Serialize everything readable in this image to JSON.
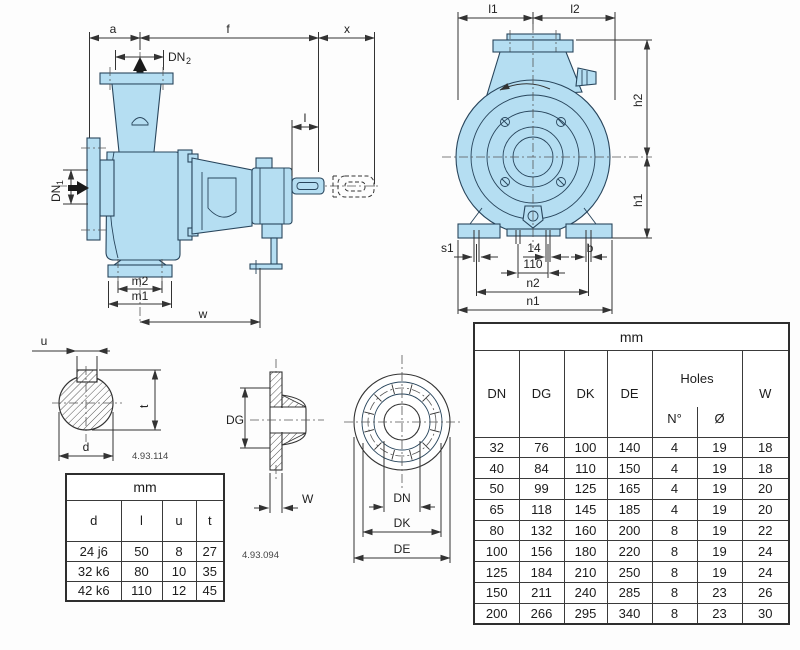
{
  "colors": {
    "pump_fill": "#b5def2",
    "line_color": "#333333",
    "table_border": "#3a3a3a",
    "background": "#fdfdfd"
  },
  "side_view": {
    "labels": {
      "a": "a",
      "f": "f",
      "x": "x",
      "dn2_base": "DN",
      "dn2_sub": "2",
      "dn1_base": "DN",
      "dn1_sub": "1",
      "l": "l",
      "m2": "m2",
      "m1": "m1",
      "w": "w"
    }
  },
  "front_view": {
    "labels": {
      "l1": "l1",
      "l2": "l2",
      "h2": "h2",
      "h1": "h1",
      "s1": "s1",
      "slot_width": "14",
      "slot_spacing": "110",
      "b": "b",
      "n2": "n2",
      "n1": "n1"
    }
  },
  "shaft_detail": {
    "labels": {
      "u": "u",
      "t": "t",
      "d": "d"
    },
    "code": "4.93.114"
  },
  "flange_detail": {
    "labels": {
      "dg": "DG",
      "w": "W",
      "dn": "DN",
      "dk": "DK",
      "de": "DE"
    },
    "code": "4.93.094"
  },
  "shaft_table": {
    "unit_header": "mm",
    "columns": [
      "d",
      "l",
      "u",
      "t"
    ],
    "rows": [
      [
        "24 j6",
        "50",
        "8",
        "27"
      ],
      [
        "32 k6",
        "80",
        "10",
        "35"
      ],
      [
        "42 k6",
        "110",
        "12",
        "45"
      ]
    ]
  },
  "flange_table": {
    "unit_header": "mm",
    "columns": [
      "DN",
      "DG",
      "DK",
      "DE"
    ],
    "holes_header": "Holes",
    "holes_subcolumns": [
      "N°",
      "Ø"
    ],
    "w_column": "W",
    "rows": [
      [
        "32",
        "76",
        "100",
        "140",
        "4",
        "19",
        "18"
      ],
      [
        "40",
        "84",
        "110",
        "150",
        "4",
        "19",
        "18"
      ],
      [
        "50",
        "99",
        "125",
        "165",
        "4",
        "19",
        "20"
      ],
      [
        "65",
        "118",
        "145",
        "185",
        "4",
        "19",
        "20"
      ],
      [
        "80",
        "132",
        "160",
        "200",
        "8",
        "19",
        "22"
      ],
      [
        "100",
        "156",
        "180",
        "220",
        "8",
        "19",
        "24"
      ],
      [
        "125",
        "184",
        "210",
        "250",
        "8",
        "19",
        "24"
      ],
      [
        "150",
        "211",
        "240",
        "285",
        "8",
        "23",
        "26"
      ],
      [
        "200",
        "266",
        "295",
        "340",
        "8",
        "23",
        "30"
      ]
    ]
  }
}
